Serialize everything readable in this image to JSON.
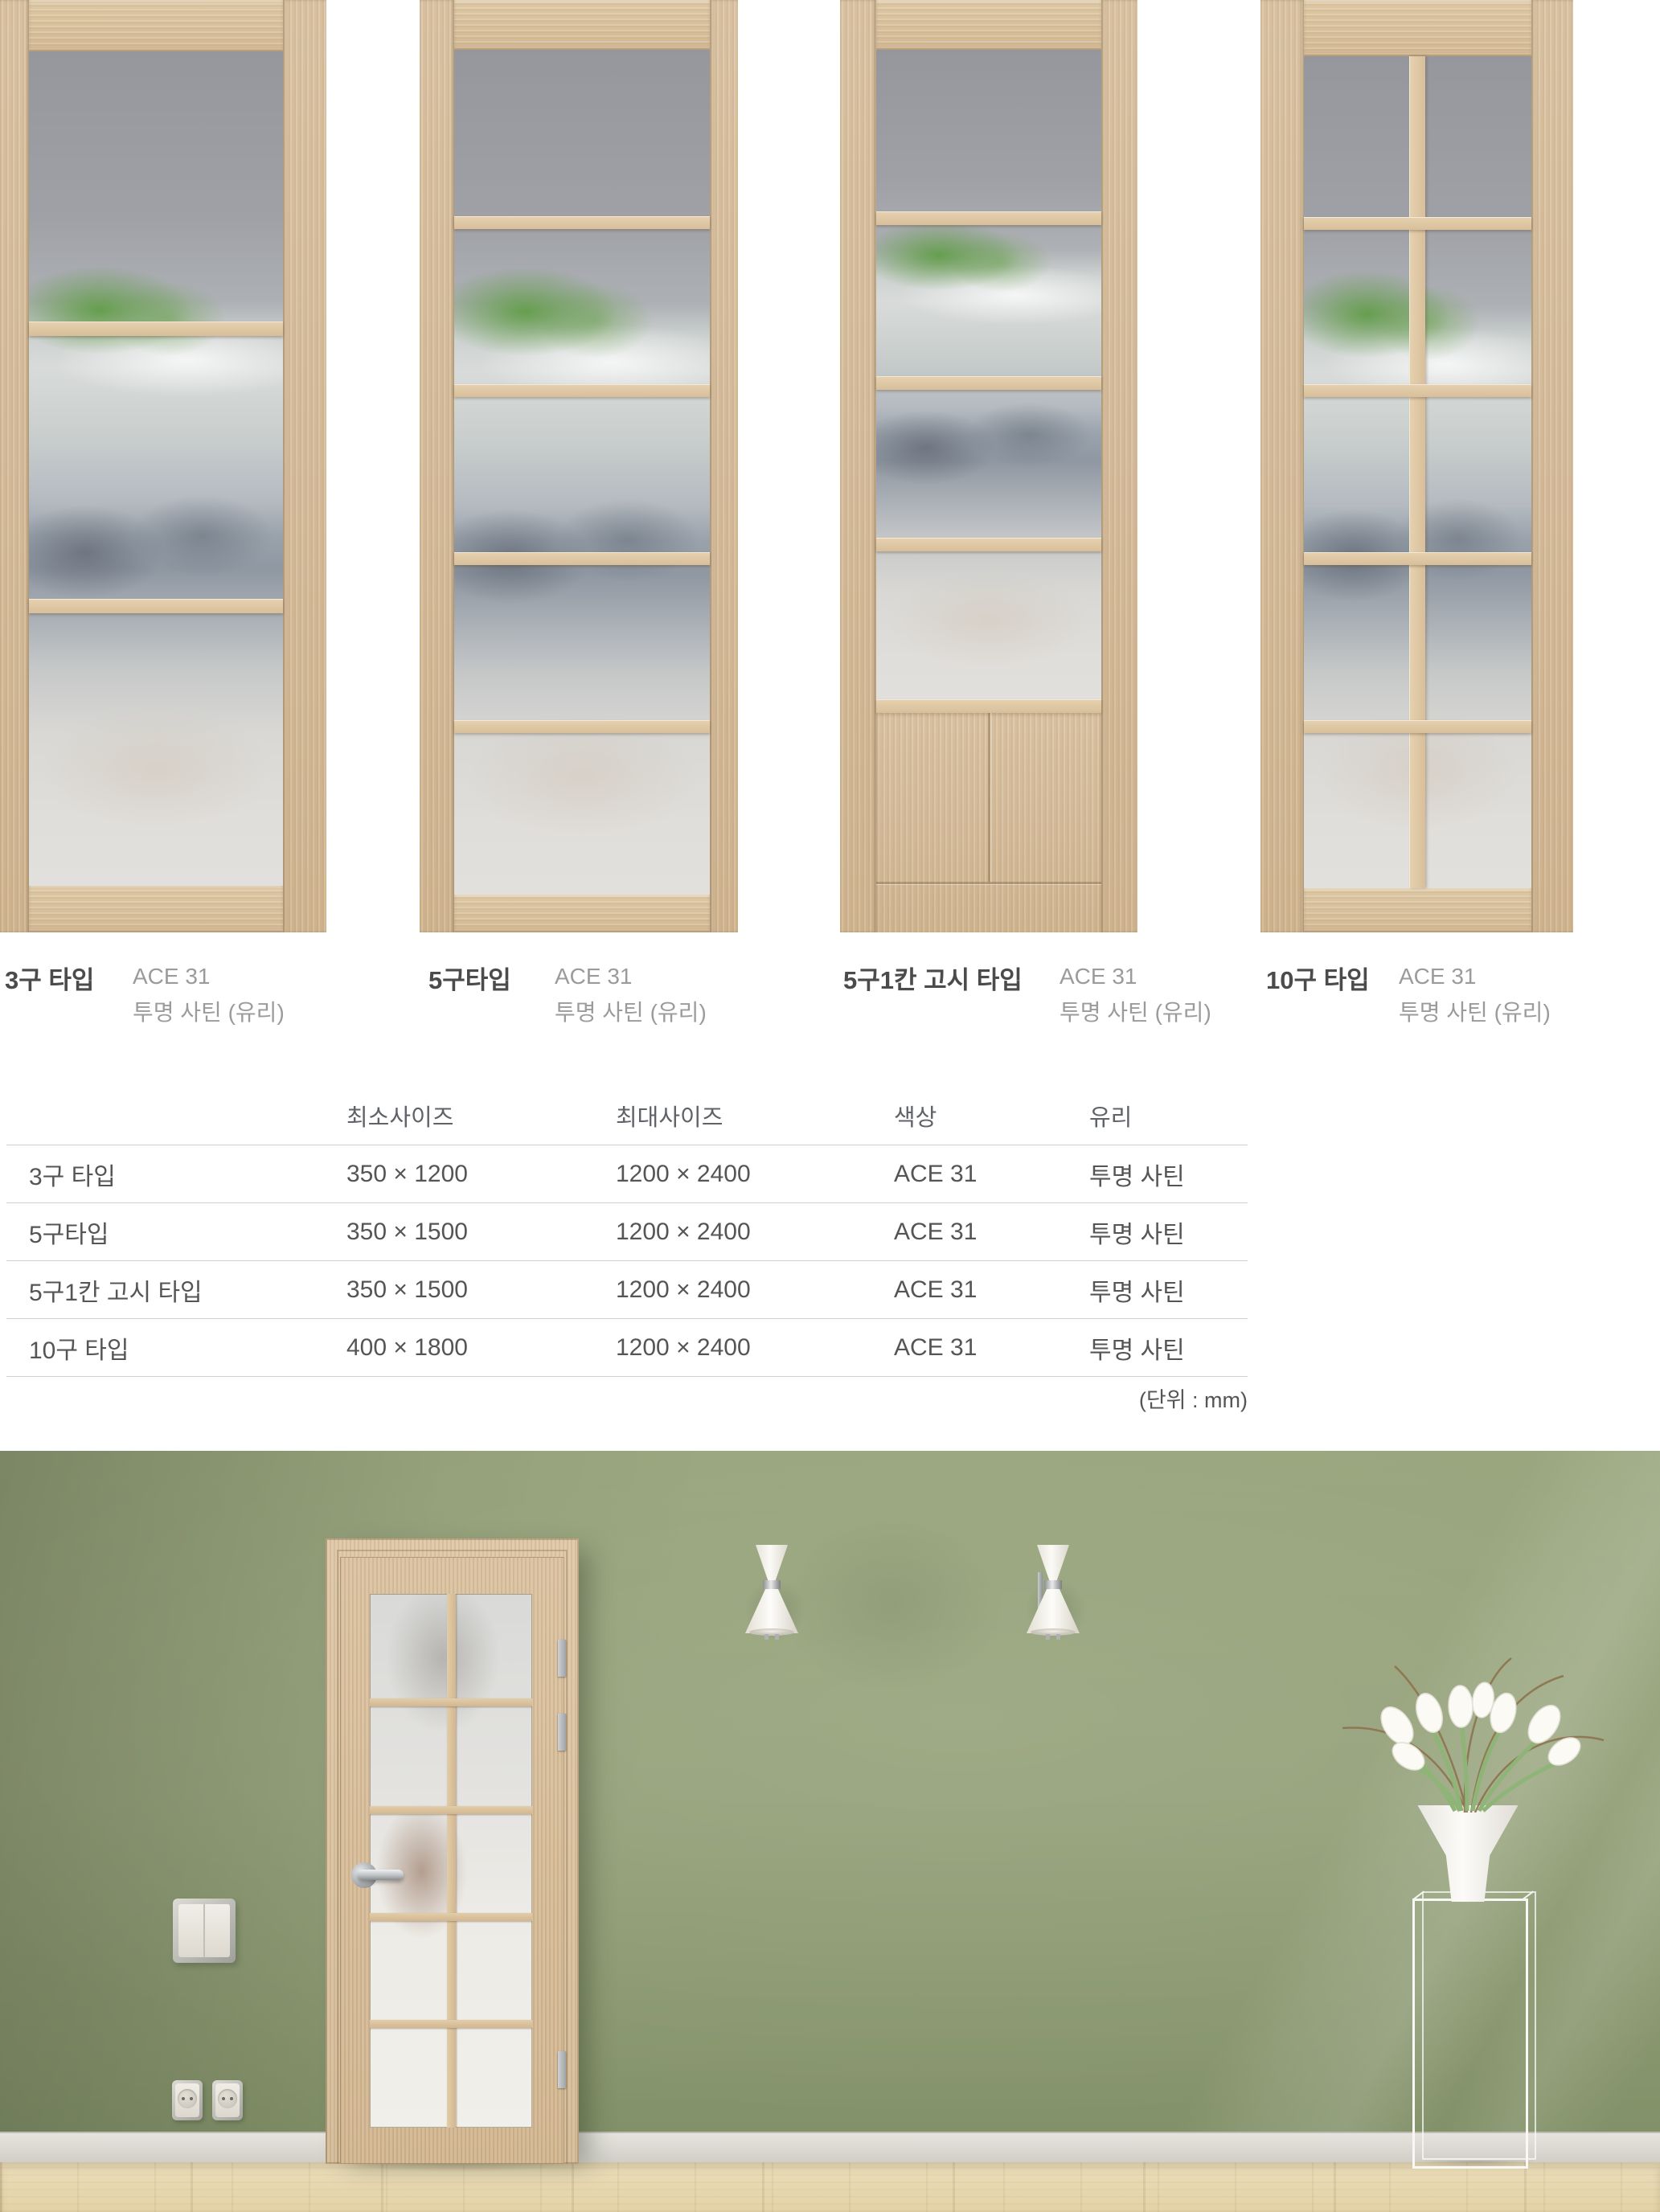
{
  "doors": [
    {
      "name": "3구 타입",
      "code": "ACE 31",
      "glass": "투명 사틴 (유리)"
    },
    {
      "name": "5구타입",
      "code": "ACE 31",
      "glass": "투명 사틴 (유리)"
    },
    {
      "name": "5구1칸 고시 타입",
      "code": "ACE 31",
      "glass": "투명 사틴 (유리)"
    },
    {
      "name": "10구 타입",
      "code": "ACE 31",
      "glass": "투명 사틴 (유리)"
    }
  ],
  "table": {
    "headers": [
      "",
      "최소사이즈",
      "최대사이즈",
      "색상",
      "유리"
    ],
    "rows": [
      [
        "3구 타입",
        "350 × 1200",
        "1200 × 2400",
        "ACE 31",
        "투명 사틴"
      ],
      [
        "5구타입",
        "350 × 1500",
        "1200 × 2400",
        "ACE 31",
        "투명 사틴"
      ],
      [
        "5구1칸 고시 타입",
        "350 × 1500",
        "1200 × 2400",
        "ACE 31",
        "투명 사틴"
      ],
      [
        "10구 타입",
        "400 × 1800",
        "1200 × 2400",
        "ACE 31",
        "투명 사틴"
      ]
    ],
    "unit_note": "(단위 : mm)"
  },
  "colors": {
    "wall_green": "#8f9c74",
    "wood_oak": "#d5bd9c",
    "floor_wood": "#e8d9b4",
    "glass_plant_green": "#5f9e46",
    "text_dark": "#4b4b4b",
    "text_muted": "#9b9b9b"
  }
}
